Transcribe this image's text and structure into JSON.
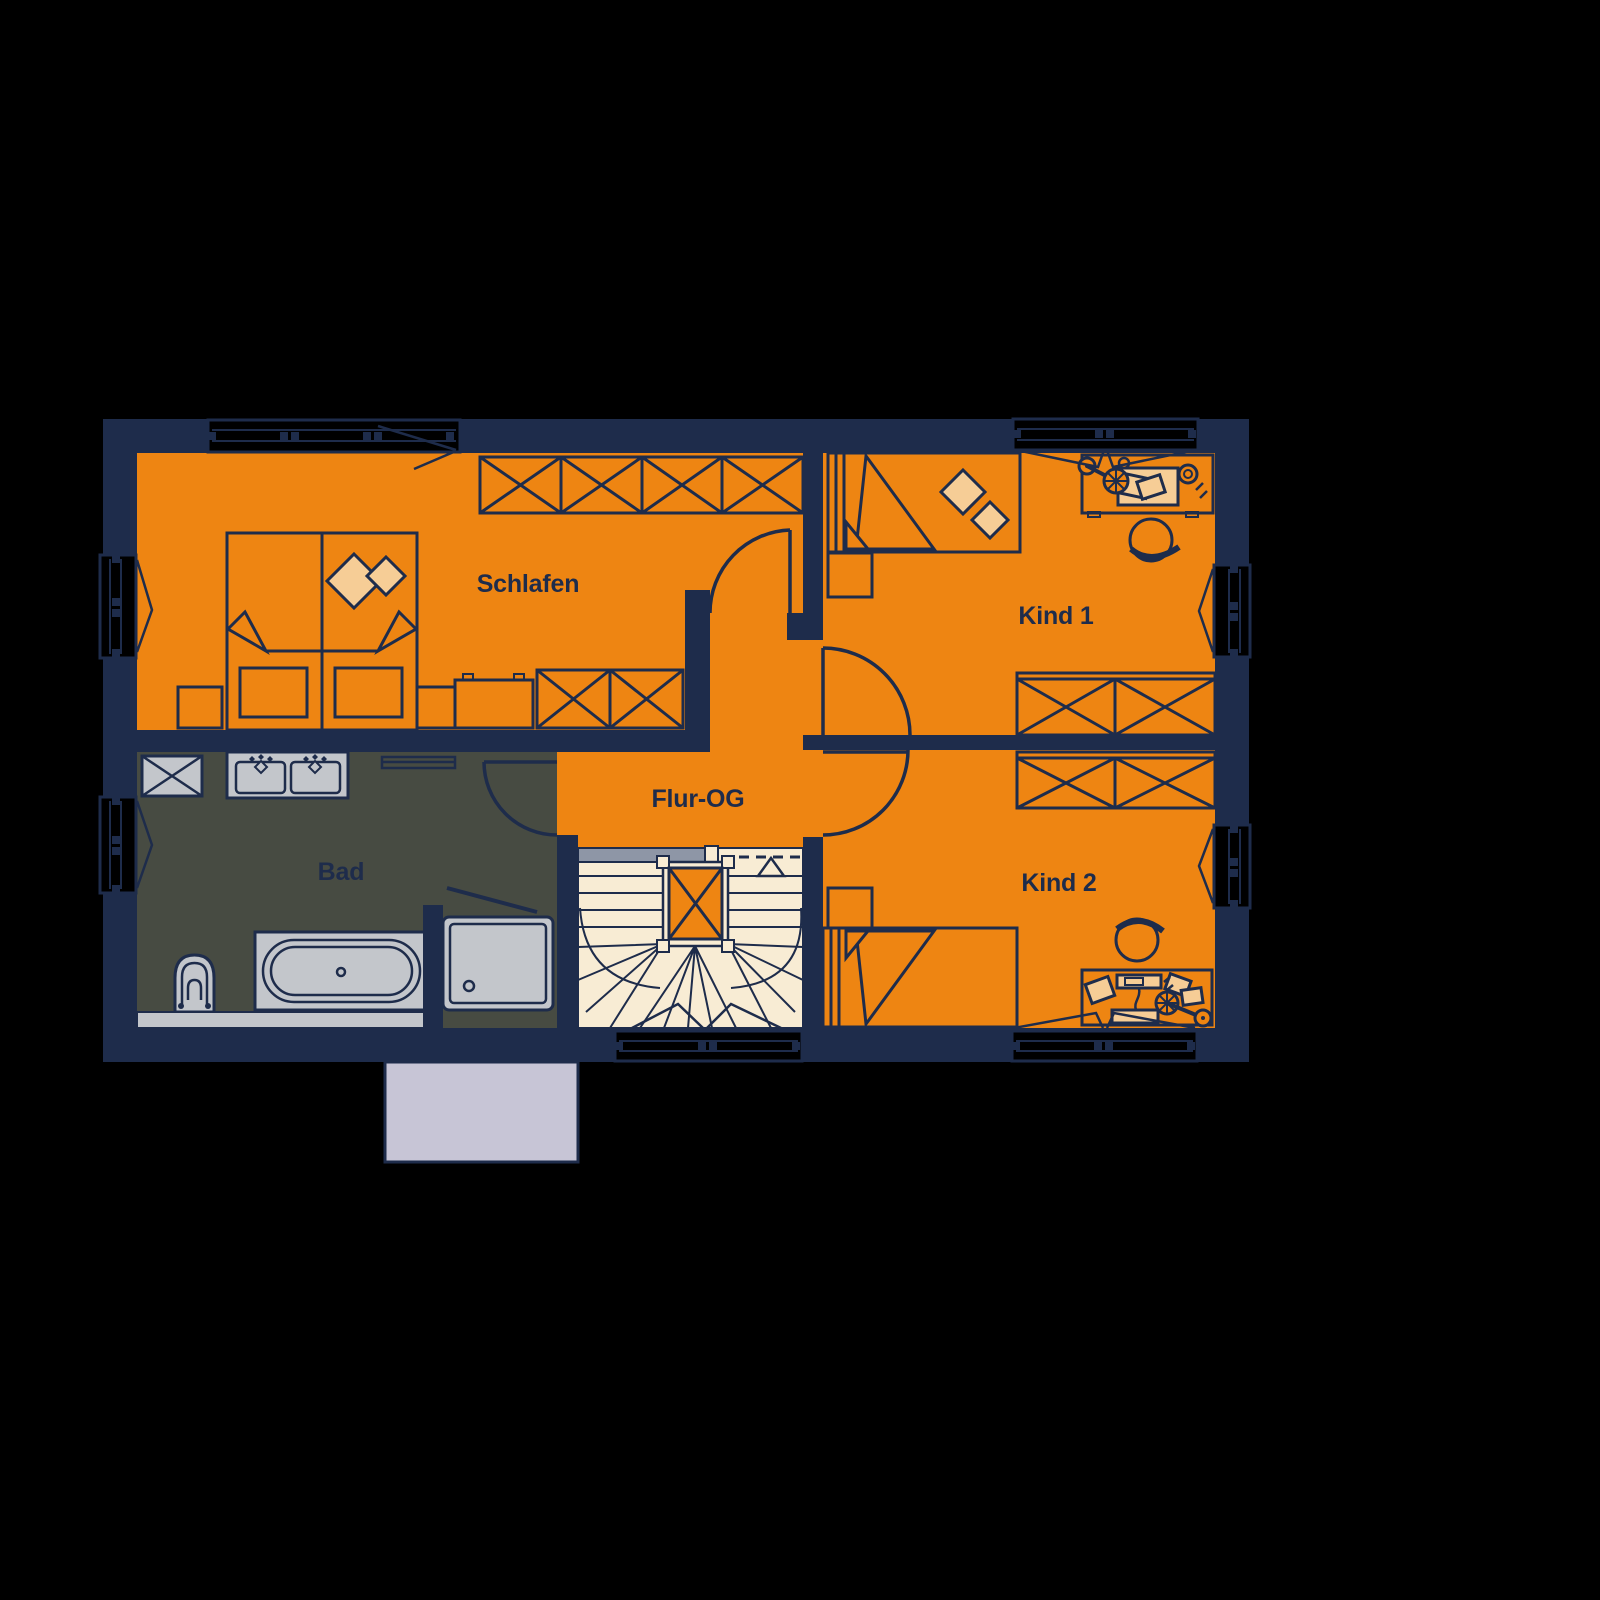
{
  "plan": {
    "level_label": "Flur-OG",
    "colors": {
      "background": "#000000",
      "wall_navy": "#1E2C4B",
      "room_orange": "#EE8512",
      "accent_peach": "#F6CD96",
      "stair_cream": "#F8ECD4",
      "bath_floor": "#474B42",
      "fixture_gray": "#C3C6CB",
      "landing_gray": "#8E96A6",
      "terrace_gray": "#C7C5D6"
    },
    "rooms": {
      "schlafen": {
        "label": "Schlafen",
        "furniture": [
          "double-bed",
          "pillows",
          "nightstand-left",
          "nightstand-right",
          "wardrobe-4-sections",
          "dresser",
          "cabinet-2-sections"
        ]
      },
      "kind1": {
        "label": "Kind 1",
        "furniture": [
          "single-bed",
          "pillows",
          "nightstand",
          "desk",
          "desk-lamp",
          "cup",
          "papers",
          "chair",
          "wardrobe-2-sections"
        ]
      },
      "kind2": {
        "label": "Kind 2",
        "furniture": [
          "single-bed",
          "nightstand",
          "desk",
          "desk-lamp",
          "monitor",
          "keyboard",
          "papers",
          "chair",
          "wardrobe-2-sections"
        ]
      },
      "bad": {
        "label": "Bad",
        "furniture": [
          "washing-machine",
          "double-sink-vanity",
          "towel-rail",
          "toilet",
          "bathtub",
          "shower"
        ]
      },
      "flur": {
        "label": "Flur-OG",
        "features": [
          "winder-staircase",
          "stair-void",
          "up-arrow",
          "landing-edge"
        ]
      }
    },
    "openings": {
      "doors": [
        "door-schlafen",
        "door-bad",
        "door-kind1",
        "door-kind2"
      ],
      "windows": [
        "window-top-schlafen",
        "window-top-kind1",
        "window-left-schlafen",
        "window-left-bad",
        "window-right-kind1",
        "window-right-kind2",
        "window-bottom-stairs",
        "window-bottom-kind2"
      ]
    }
  }
}
